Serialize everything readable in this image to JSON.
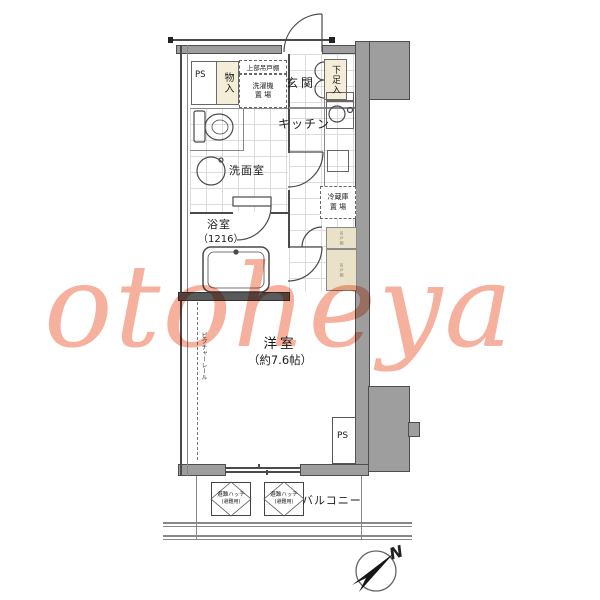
{
  "watermark": {
    "text": "otoheya",
    "color": "#f5a28d"
  },
  "plan": {
    "labels": {
      "ps_top": "PS",
      "storage": "物入",
      "upper_cabinet": "上部吊戸棚",
      "washer1": "洗濯機",
      "washer2": "置 場",
      "entrance": "玄関",
      "shoe": "下足入",
      "kitchen": "キッチン",
      "fridge1": "冷蔵庫",
      "fridge2": "置 場",
      "washroom": "洗面室",
      "bath": "浴室",
      "bath_size": "（1216）",
      "cab": "吊戸棚",
      "room": "洋室",
      "room_size": "（約7.6帖）",
      "picture_rail": "ピクチャーレール",
      "ps_bottom": "PS",
      "balcony": "バルコニー",
      "hatch": "避難ハッチ",
      "hatch_sub": "(避難用)",
      "north": "N"
    },
    "colors": {
      "wall_gray": "#9e9e9e",
      "line": "#4a4a4a",
      "fixture_cream": "#f4eed8",
      "cabinet_tan": "#eae2c8",
      "watermark_pink": "#f5a28d"
    }
  }
}
